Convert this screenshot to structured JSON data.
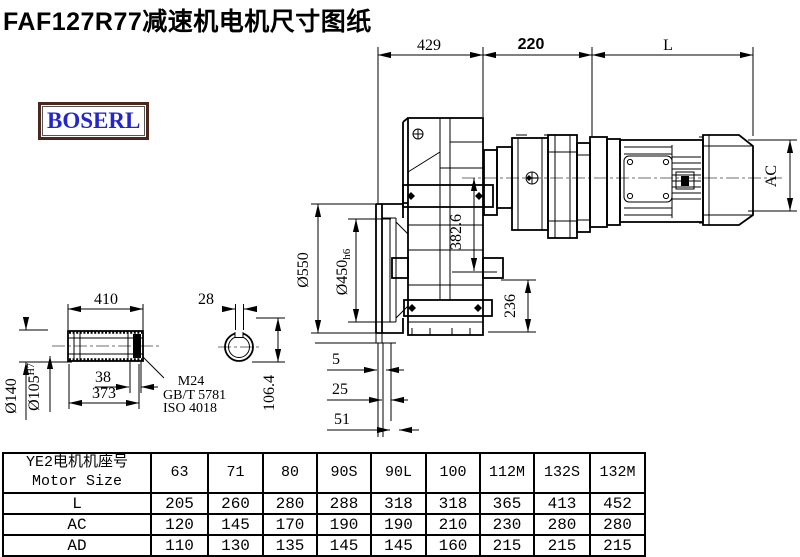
{
  "title": "FAF127R77减速机电机尺寸图纸",
  "logo": "BOSERL",
  "colors": {
    "line": "#000000",
    "logo_text": "#2526c9",
    "logo_border": "#4a281e",
    "centerline": "#8a8a8a"
  },
  "drawing": {
    "dims": {
      "top_left": "429",
      "top_mid": "220",
      "top_right": "L",
      "flange_od": "Ø550",
      "pilot_main": "Ø450",
      "pilot_suffix": "h6",
      "height_center": "382.6",
      "height_foot": "236",
      "motor_diameter": "AC",
      "shaft_len": "410",
      "hub_od": "Ø140",
      "bore_main": "Ø105",
      "bore_suffix": "H7",
      "key_len": "38",
      "bore_depth": "373",
      "key_width": "28",
      "key_height": "106.4",
      "gap1": "5",
      "gap2": "25",
      "gap3": "51"
    },
    "notes": {
      "thread": "M24",
      "std1": "GB/T 5781",
      "std2": "ISO 4018"
    }
  },
  "table": {
    "header_cn": "YE2电机机座号",
    "header_en": "Motor Size",
    "columns": [
      "63",
      "71",
      "80",
      "90S",
      "90L",
      "100",
      "112M",
      "132S",
      "132M"
    ],
    "rows": [
      {
        "label": "L",
        "values": [
          "205",
          "260",
          "280",
          "288",
          "318",
          "318",
          "365",
          "413",
          "452"
        ]
      },
      {
        "label": "AC",
        "values": [
          "120",
          "145",
          "170",
          "190",
          "190",
          "210",
          "230",
          "280",
          "280"
        ]
      },
      {
        "label": "AD",
        "values": [
          "110",
          "130",
          "135",
          "145",
          "145",
          "160",
          "215",
          "215",
          "215"
        ]
      }
    ]
  }
}
